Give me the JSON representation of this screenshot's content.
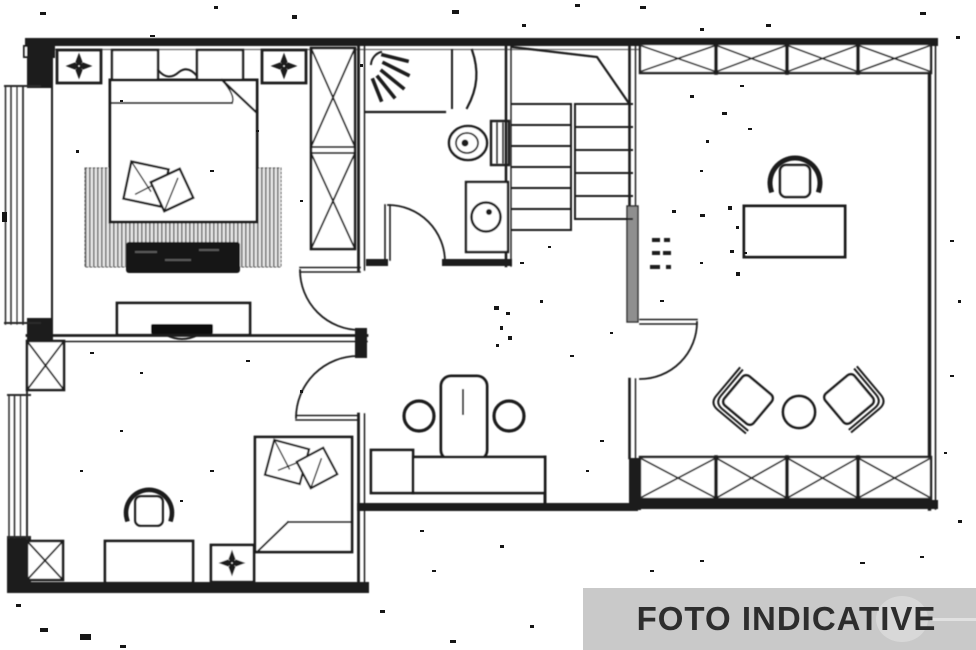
{
  "banner": {
    "label": "FOTO INDICATIVE",
    "background_color": "#c9c9c9",
    "text_color": "#2d2d2d"
  },
  "drawing": {
    "type": "floor-plan",
    "ink_color": "#1f1f1f",
    "paper_color": "#ffffff",
    "rooms": [
      "master-bedroom",
      "bathroom",
      "staircase",
      "study-living-room",
      "second-bedroom",
      "hallway-kitchenette"
    ],
    "furniture_symbols": [
      "double-bed",
      "area-rug",
      "storage-bench",
      "tv-console",
      "wardrobe-unit",
      "ceiling-light",
      "shower-head",
      "toilet",
      "washbasin",
      "stair-flight",
      "office-desk",
      "office-chair",
      "armchair",
      "round-side-table",
      "high-table",
      "stool",
      "kitchen-counter",
      "single-bed",
      "window-band",
      "door-swing"
    ]
  }
}
